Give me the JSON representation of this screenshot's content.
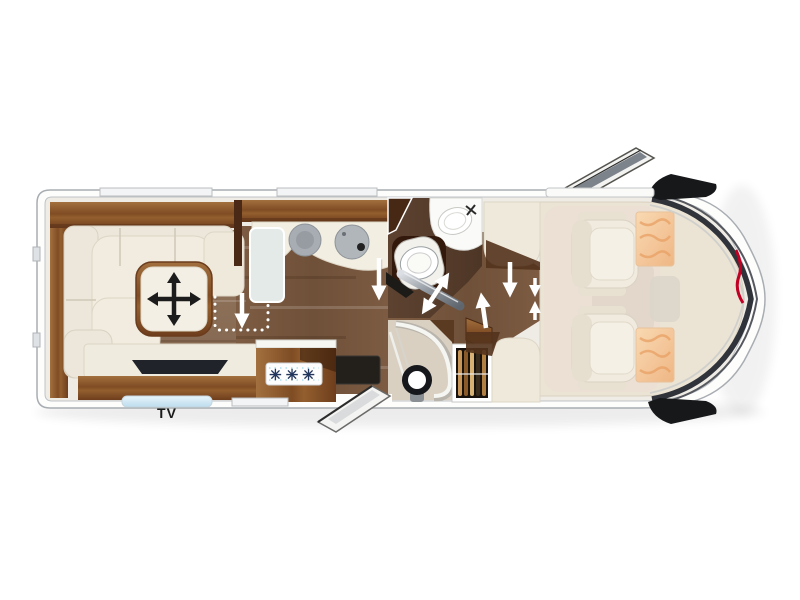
{
  "scene": {
    "description": "Top-view floor plan of a Carthago-style motorhome",
    "background": "#ffffff"
  },
  "labels": {
    "tv": "TV",
    "fridge_rating": "✳✳✳"
  },
  "icons": {
    "table_icon": "move-cross-arrows-icon",
    "bathroom_door_icon": "slide-double-arrow-icon",
    "walkway_icons": "white-direction-arrows",
    "front_logo_icon": "carthago-logo-mark",
    "fridge_icon": "freezer-snowflakes"
  },
  "colors": {
    "body_outline": "#a8adb2",
    "cabinet_wood": "#8a5a32",
    "corridor_floor": "#6e5038",
    "bathroom_floor": "#543b2a",
    "lounge_floor": "#8d7058",
    "upholstery": "#f0ebdf",
    "cab_mat": "#ecdfd4",
    "visor_pattern": "#f3c79c",
    "arrow": "#ffffff",
    "tv_panel": "#20242a",
    "snowflake_text": "#23365c",
    "logo_accent": "#c00024",
    "step_blue": "#cfe6f2",
    "mirror_black": "#16181a"
  }
}
